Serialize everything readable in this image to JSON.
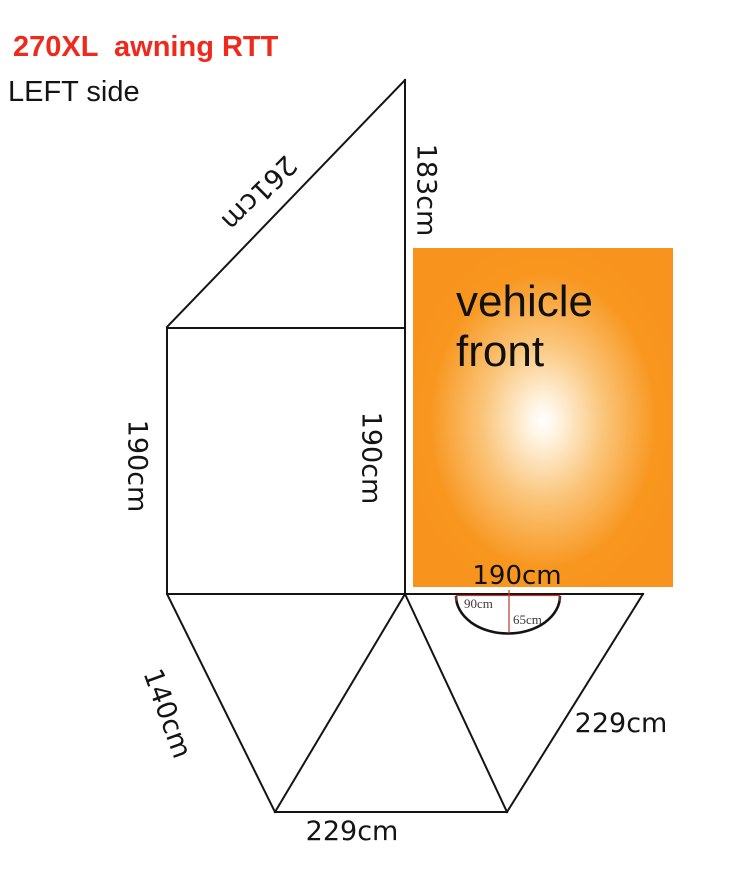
{
  "header": {
    "title": "270XL  awning RTT",
    "subtitle": "LEFT side"
  },
  "vehicle": {
    "label_line1": "vehicle",
    "label_line2": "front",
    "width_label": "190cm"
  },
  "awning": {
    "roof_triangle": {
      "hypotenuse_label": "261cm",
      "rear_edge_label": "183cm"
    },
    "side_panel": {
      "outer_height_label": "190cm",
      "inner_height_label": "190cm"
    },
    "floor_fan": {
      "left_edge_label": "140cm",
      "right_edge_label": "229cm",
      "bottom_edge_label": "229cm"
    },
    "door_arch": {
      "width_label": "90cm",
      "drop_label": "65cm"
    }
  },
  "colors": {
    "title_red": "#EE2A1C",
    "outline_black": "#141414",
    "measure_red": "#C0392B",
    "vehicle_orange": "#F8941D",
    "vehicle_glow_center": "#FFFFFF",
    "small_label_gray": "#3B3B3B"
  }
}
